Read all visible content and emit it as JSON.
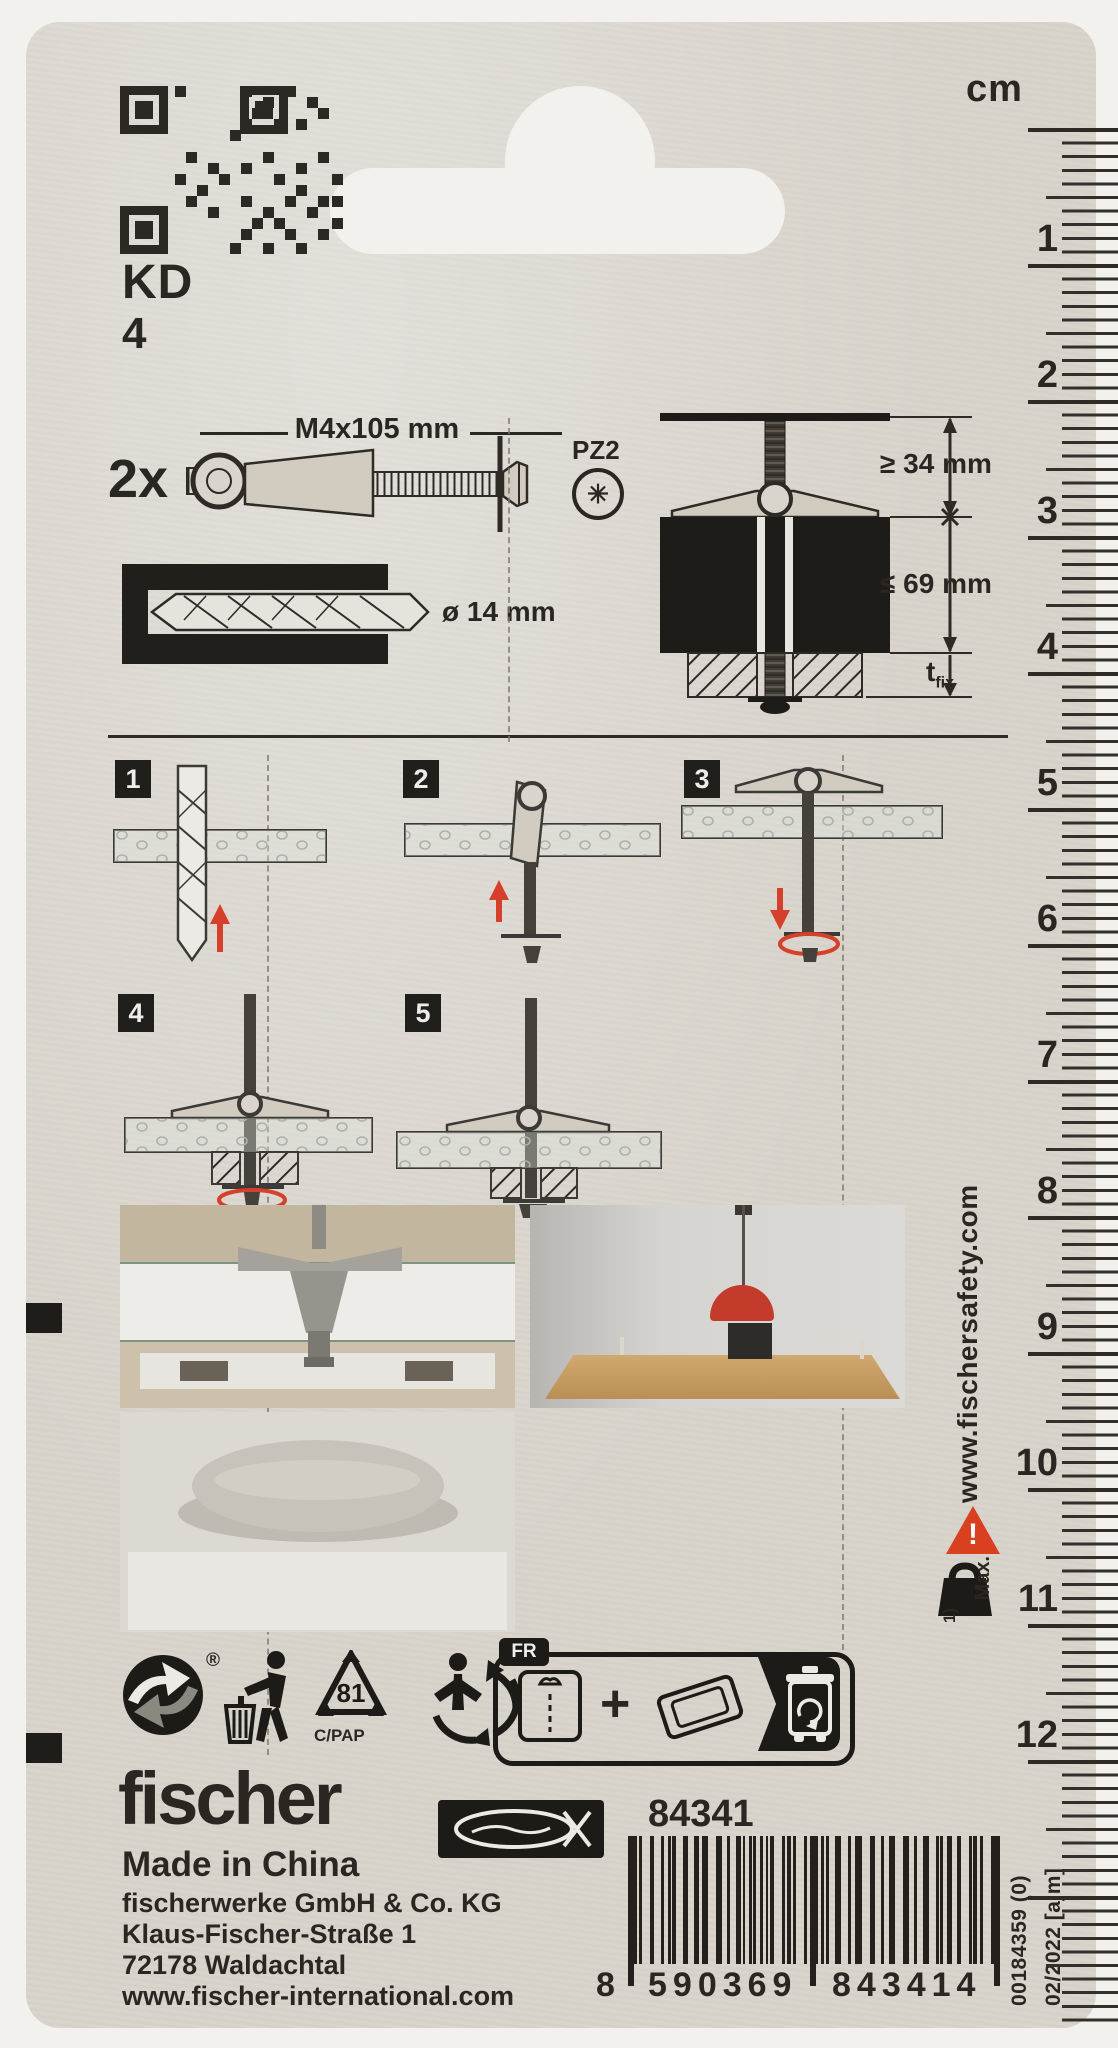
{
  "product": {
    "line": "KD",
    "size": "4"
  },
  "specs": {
    "quantity": "2x",
    "screw": "M4x105 mm",
    "drive": "PZ2",
    "drill": "ø 14 mm"
  },
  "install": {
    "cavity": "≥ 34 mm",
    "wall": "≤ 69 mm",
    "tfix_main": "t",
    "tfix_sub": "fix"
  },
  "steps": {
    "labels": [
      "1",
      "2",
      "3",
      "4",
      "5"
    ]
  },
  "ruler": {
    "unit": "cm",
    "numbers": [
      1,
      2,
      3,
      4,
      5,
      6,
      7,
      8,
      9,
      10,
      11,
      12
    ]
  },
  "side": {
    "website": "www.fischersafety.com",
    "warning": "!",
    "max_label": "Max.",
    "note": "1)"
  },
  "recycle": {
    "reg": "®",
    "resin_code": "81",
    "material": "C/PAP",
    "fr": "FR",
    "plus": "+"
  },
  "brand": {
    "name": "fischer",
    "article": "84341",
    "origin": "Made in China",
    "company": "fischerwerke GmbH & Co. KG",
    "street": "Klaus-Fischer-Straße 1",
    "city": "72178 Waldachtal",
    "website": "www.fischer-international.com"
  },
  "barcode": {
    "lead": "8",
    "group1": "590369",
    "group2": "843414",
    "note1": "00184359 (0)",
    "note2": "02/2022 [ajm]"
  },
  "colors": {
    "accent_red": "#d6402b",
    "card": "#d9d5cd",
    "ink": "#2a2723"
  }
}
